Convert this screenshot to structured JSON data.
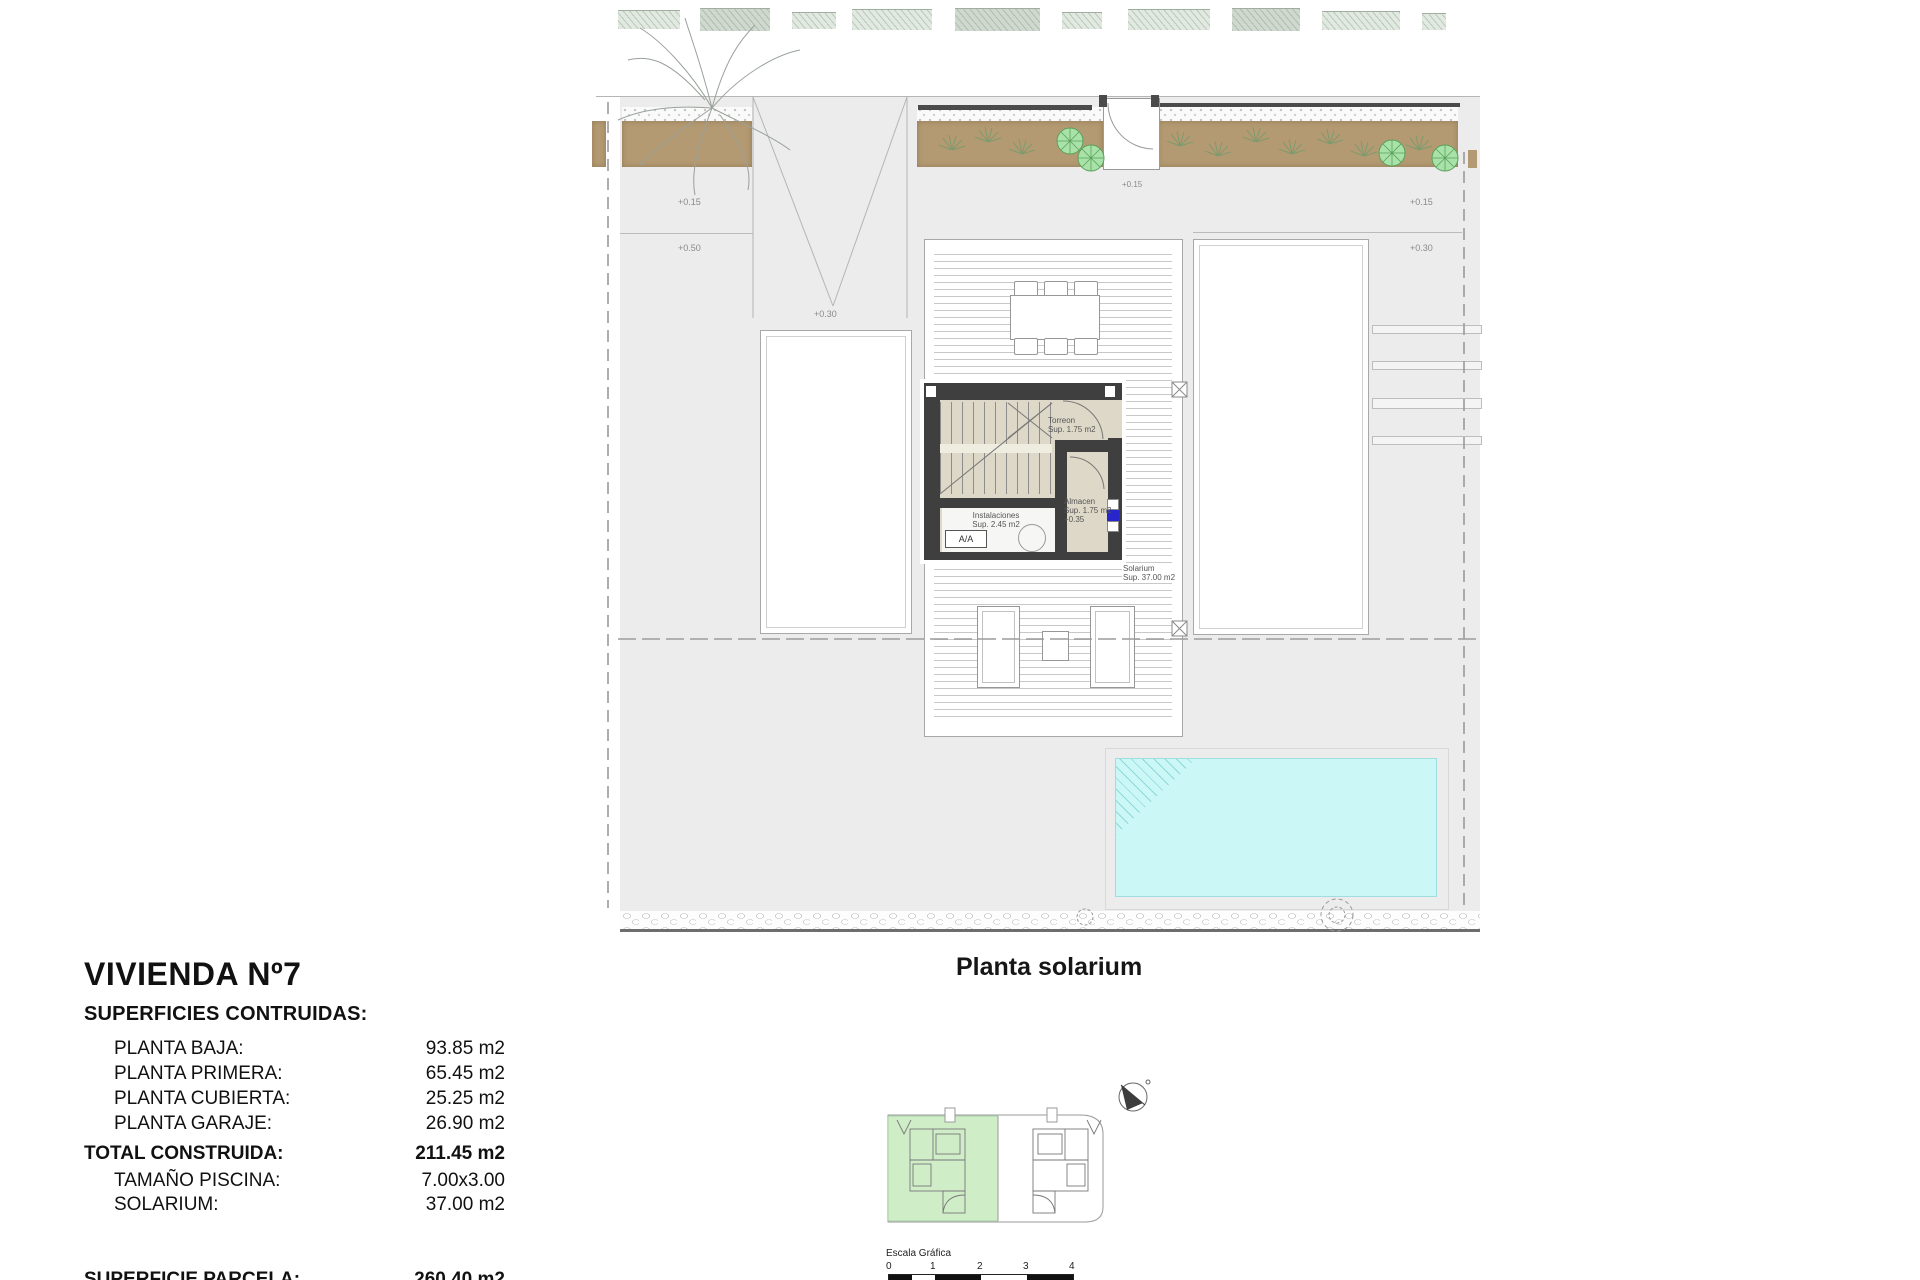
{
  "info_panel": {
    "title": "VIVIENDA Nº7",
    "subtitle": "SUPERFICIES CONTRUIDAS:",
    "rows": [
      {
        "label": "PLANTA BAJA:",
        "value": "93.85 m2"
      },
      {
        "label": "PLANTA PRIMERA:",
        "value": "65.45 m2"
      },
      {
        "label": "PLANTA CUBIERTA:",
        "value": "25.25 m2"
      },
      {
        "label": "PLANTA GARAJE:",
        "value": "26.90 m2"
      }
    ],
    "total": {
      "label": "TOTAL CONSTRUIDA:",
      "value": "211.45 m2"
    },
    "pool_row": {
      "label": "TAMAÑO PISCINA:",
      "value": "7.00x3.00"
    },
    "solarium_row": {
      "label": "SOLARIUM:",
      "value": "37.00 m2"
    },
    "parcel_row": {
      "label": "SUPERFICIE PARCELA:",
      "value": "260.40 m2"
    }
  },
  "plan": {
    "caption": "Planta solarium",
    "levels": {
      "left_upper": "+0.15",
      "left_lower": "+0.50",
      "ramp": "+0.30",
      "right_upper": "+0.15",
      "right_lower": "+0.30"
    },
    "rooms": {
      "torreon_name": "Torreon",
      "torreon_sup": "Sup. 1.75 m2",
      "almacen_name": "Almacen",
      "almacen_sup": "Sup. 1.75 m2",
      "almacen_level": "+0.35",
      "instalaciones_name": "Instalaciones",
      "instalaciones_sup": "Sup. 2.45 m2",
      "aa_unit": "A/A",
      "solarium_name": "Solarium",
      "solarium_sup": "Sup. 37.00 m2"
    },
    "colors": {
      "pool": "#cbf7f7",
      "planting_bed": "#b49a72",
      "wall": "#3f3f3f",
      "core_floor": "#ddd8c7",
      "terrain": "#ececec",
      "key_highlight": "#cfeec8",
      "panel_blue": "#2626cc"
    }
  },
  "scale_bar": {
    "title": "Escala Gráfica",
    "ticks": [
      "0",
      "1",
      "2",
      "3",
      "4"
    ]
  }
}
